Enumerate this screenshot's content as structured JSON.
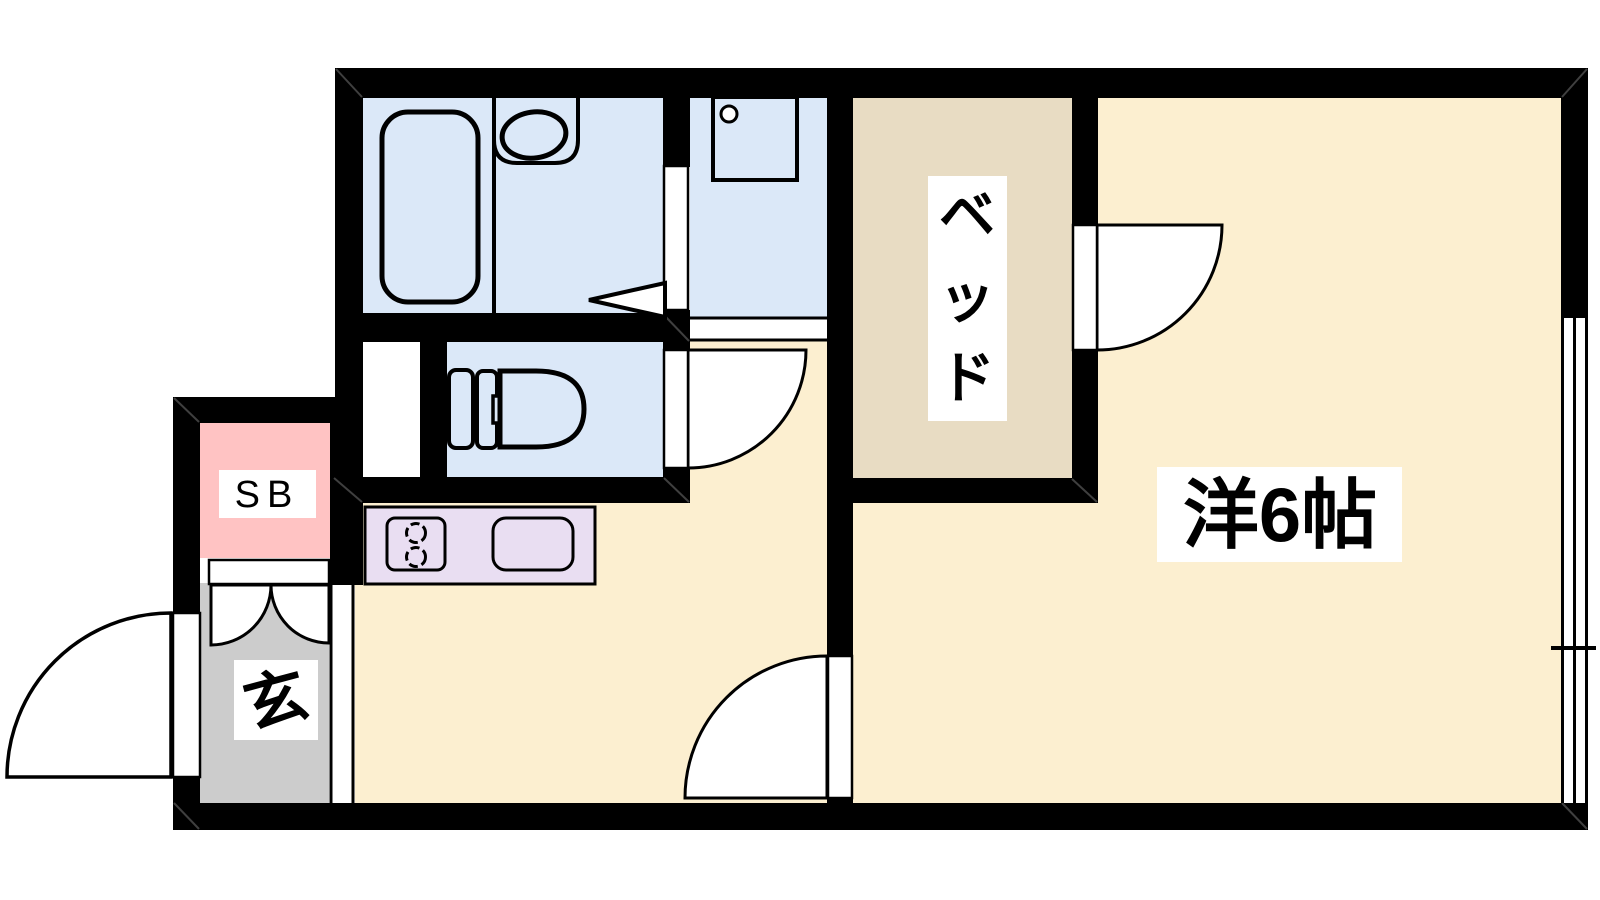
{
  "colors": {
    "wall": "#000000",
    "wet": "#dbe8f8",
    "floor": "#fcefd0",
    "bed": "#e8dcc3",
    "counter": "#e9def2",
    "shoebox": "#ffc3c3",
    "entrance": "#cccccc",
    "label_bg": "#ffffff"
  },
  "labels": {
    "main_room": "洋6帖",
    "bed": "ベッド",
    "bed_chars": [
      "ベ",
      "ッ",
      "ド"
    ],
    "shoebox": "SB",
    "entrance": "玄"
  }
}
